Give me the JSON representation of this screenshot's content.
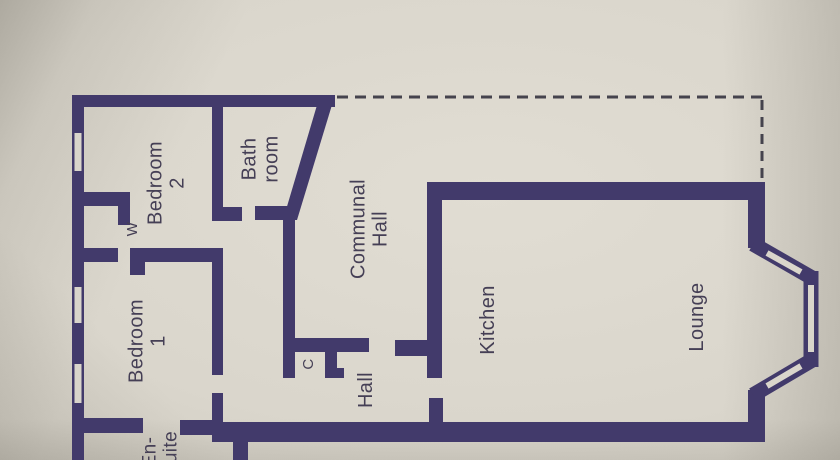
{
  "plan": {
    "type": "floor-plan",
    "rooms": [
      {
        "id": "bedroom-2",
        "lines": [
          "Bedroom",
          "2"
        ]
      },
      {
        "id": "bathroom",
        "lines": [
          "Bath",
          "room"
        ]
      },
      {
        "id": "communal-hall",
        "lines": [
          "Communal",
          "Hall"
        ]
      },
      {
        "id": "bedroom-1",
        "lines": [
          "Bedroom",
          "1"
        ]
      },
      {
        "id": "hall",
        "lines": [
          "Hall"
        ]
      },
      {
        "id": "cupboard",
        "lines": [
          "C"
        ]
      },
      {
        "id": "wardrobe",
        "lines": [
          "W"
        ]
      },
      {
        "id": "kitchen",
        "lines": [
          "Kitchen"
        ]
      },
      {
        "id": "lounge",
        "lines": [
          "Lounge"
        ]
      },
      {
        "id": "en-suite",
        "lines": [
          "En-",
          "suite"
        ]
      }
    ],
    "colors": {
      "wall": "#423a6b",
      "paper": "#d9d5cb",
      "ink": "#453f55",
      "dash": "#45434d"
    }
  }
}
